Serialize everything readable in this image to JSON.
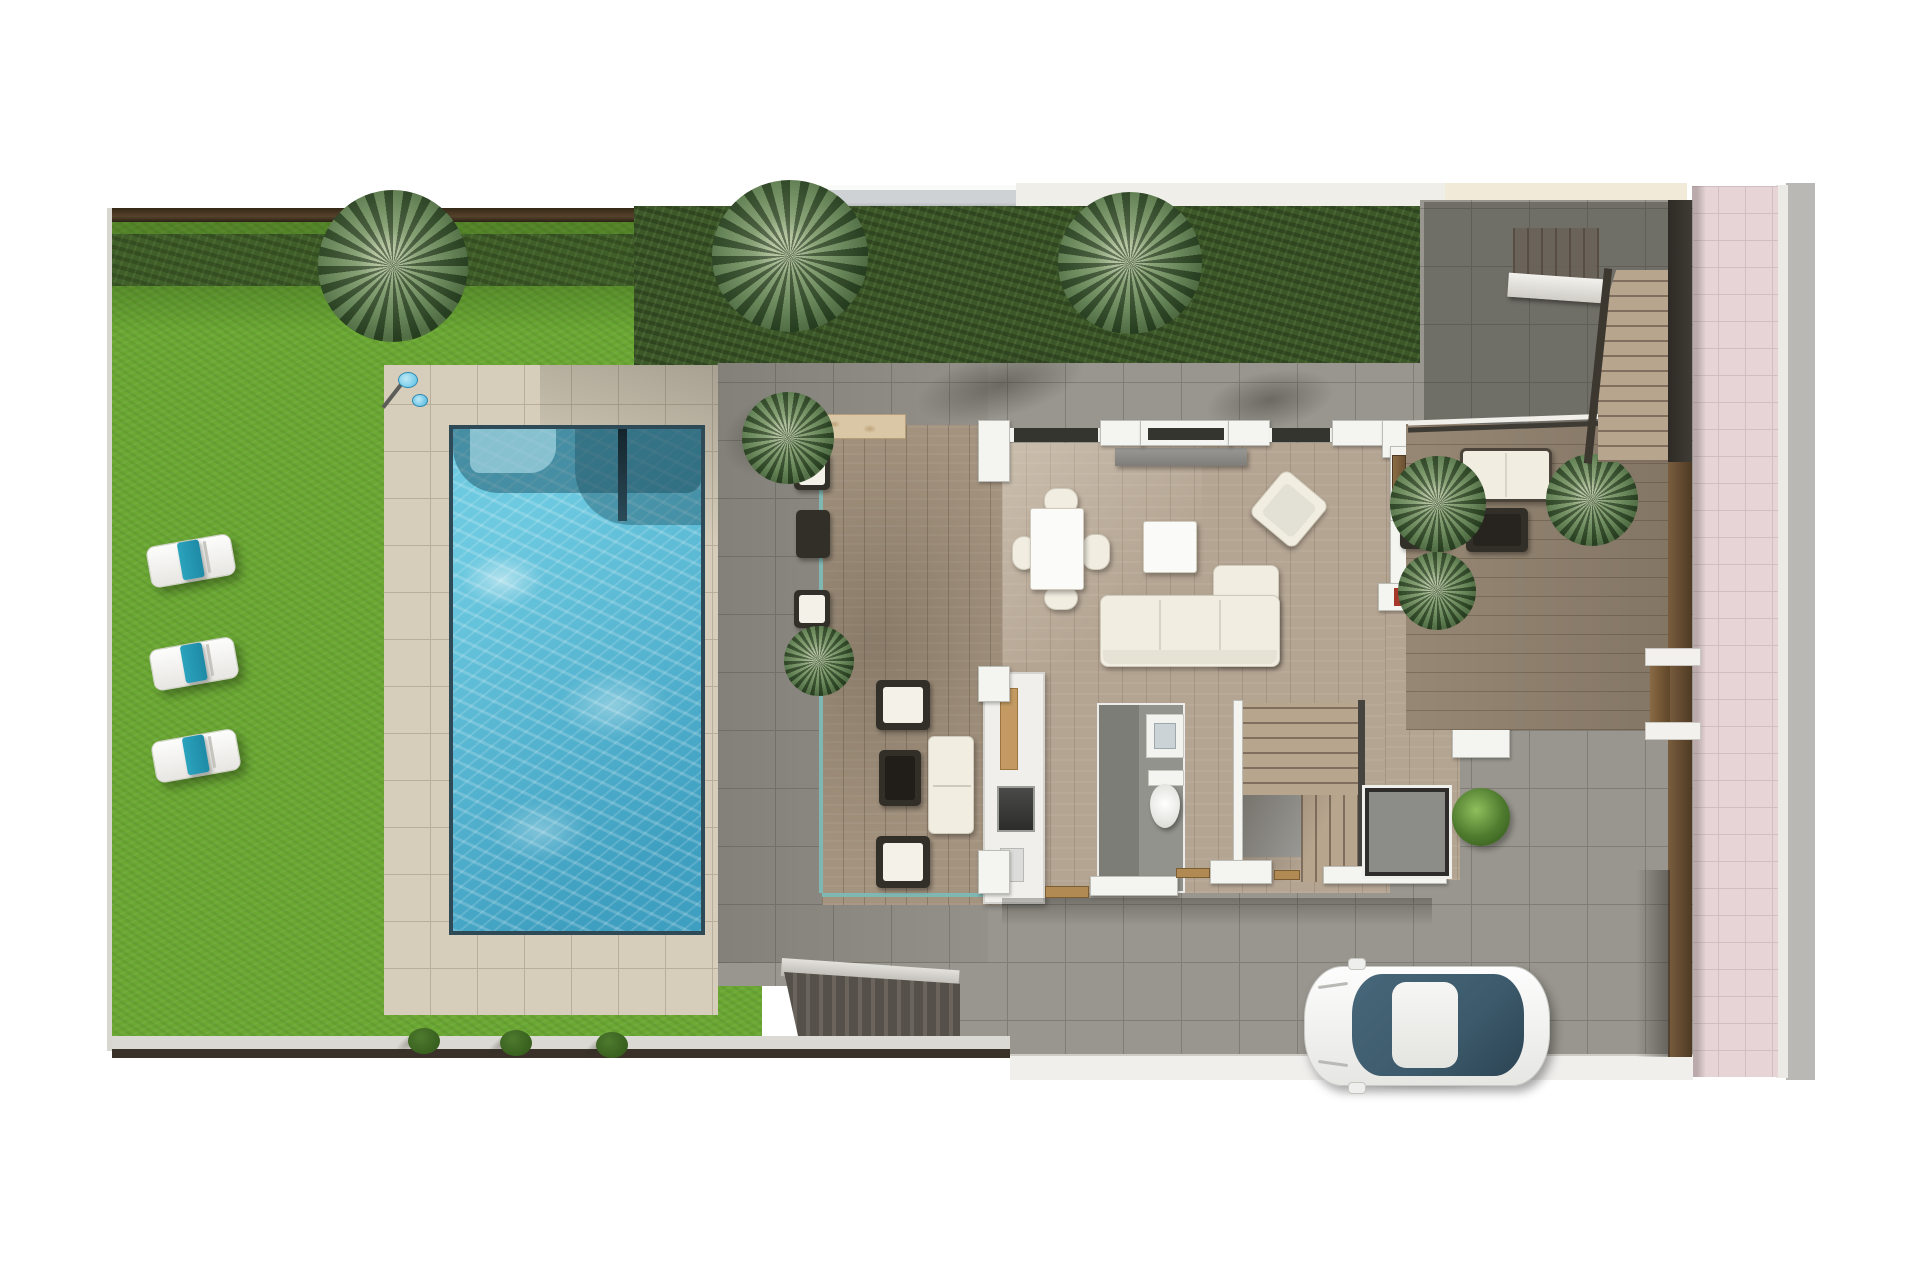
{
  "scene": {
    "title": "Top-down 3D architectural render — villa ground floor with garden, pool, terraces and driveway",
    "view": "top-down",
    "canvas": {
      "width": 1920,
      "height": 1280
    },
    "areas": [
      "garden-lawn",
      "hedge",
      "pool-terrace",
      "swimming-pool",
      "covered-deck",
      "living-dining-room",
      "kitchen",
      "bathroom",
      "interior-staircase",
      "entrance-porch",
      "side-terrace",
      "external-staircase",
      "driveway",
      "pink-sidewalk",
      "road"
    ],
    "objects": {
      "sun_loungers": 3,
      "lounger_towels": 3,
      "palm_trees": 8,
      "boundary_bushes": 3,
      "swimming_pools": 1,
      "cars": 1,
      "outdoor_showers": 1,
      "dining_chairs": 4,
      "sofas": 3
    }
  },
  "palette": {
    "page_bg": "#ffffff",
    "lawn": "#6aa833",
    "hedge": "#3c5829",
    "pool_deck": "#d6cdbb",
    "deck_line": "#b9ae9b",
    "pool_edge": "#2e4a56",
    "pool_water": "#6cc9e0",
    "pool_water_deep": "#3f9fc0",
    "terrace": "#98968e",
    "terrace_line": "#7f7d75",
    "wood_deck": "#a3937f",
    "wood_interior": "#b4a492",
    "wall_white": "#f4f4f1",
    "wall_gray": "#bdbdb8",
    "glass_dark": "#35352f",
    "door_wood": "#8a6b44",
    "sofa_cream": "#f1ede1",
    "wicker_dark": "#322e28",
    "towel_teal": "#2ba3bd",
    "sidewalk_pink": "#e6d4d6",
    "pink_line": "#d2bec1",
    "road_gray": "#bab8b4",
    "curb_light": "#eceae4",
    "fence_brown": "#6b5035",
    "fence_dark": "#3f3b35",
    "car_glass": "#3c5a6b",
    "bush_green": "#4e7a2e",
    "travertine": "#d9c7a6",
    "ramp_dark": "#55504a",
    "mat_gray": "#8c8c88",
    "stair_wood": "#b7a58e",
    "niche_red": "#a5372b",
    "boundary_brown": "#55422c",
    "neighbor_glass": "#cfd2d4",
    "neighbor_bone": "#efeee8",
    "neighbor_cream": "#f1ead9"
  }
}
